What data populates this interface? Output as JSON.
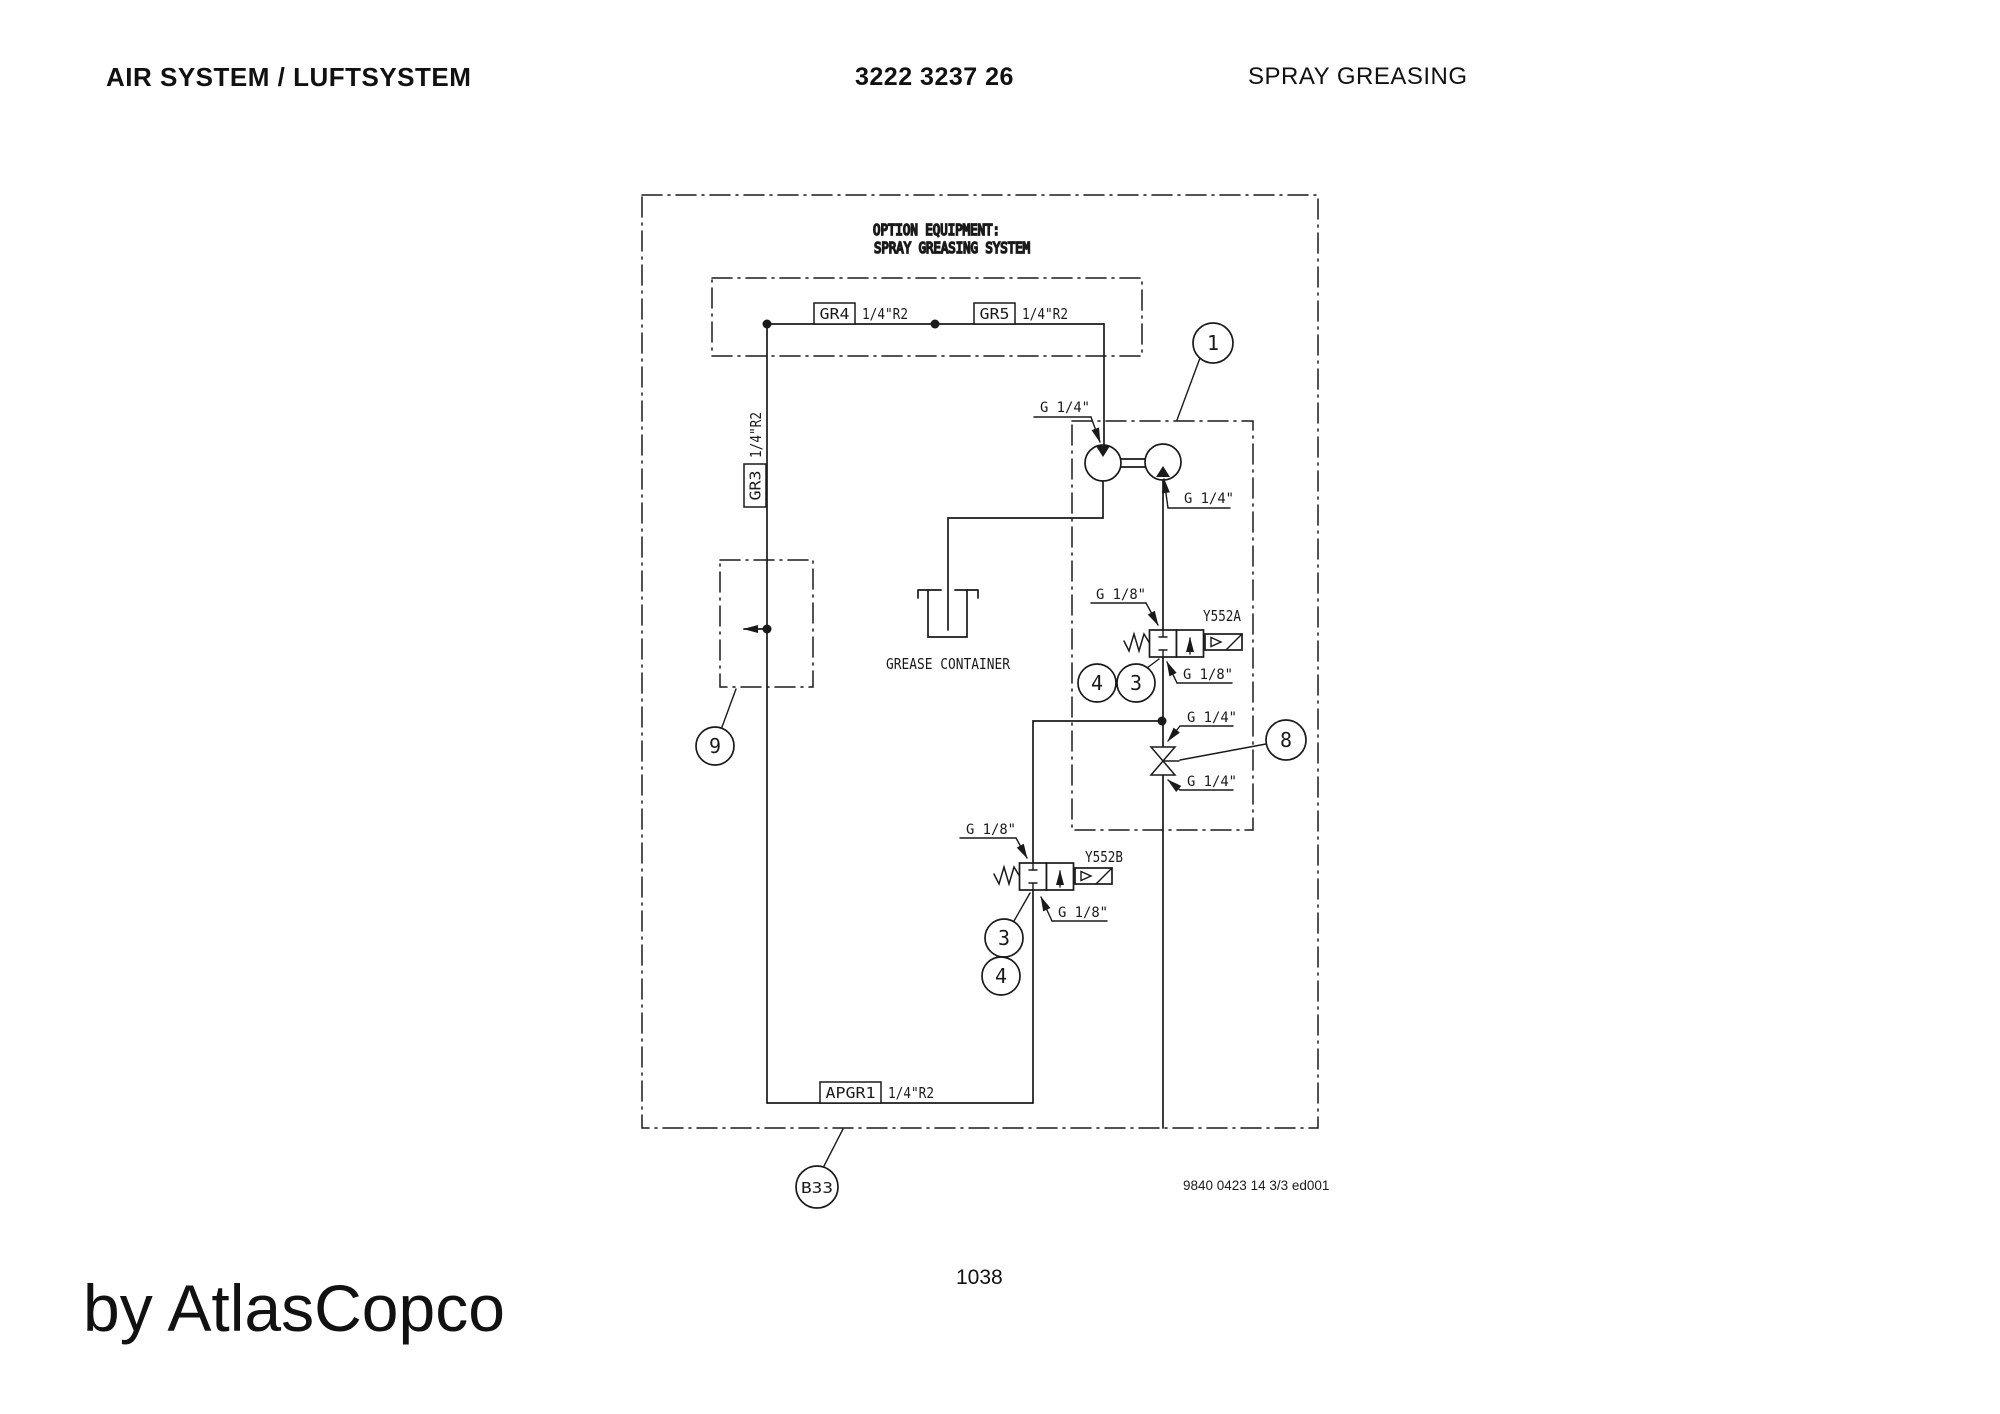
{
  "header": {
    "left_title": "AIR SYSTEM / LUFTSYSTEM",
    "doc_number": "3222 3237 26",
    "right_title": "SPRAY GREASING"
  },
  "diagram": {
    "title_line1": "OPTION EQUIPMENT:",
    "title_line2": "SPRAY GREASING SYSTEM",
    "tags": {
      "gr4": "GR4",
      "gr4_size": "1/4\"R2",
      "gr5": "GR5",
      "gr5_size": "1/4\"R2",
      "gr3": "GR3",
      "gr3_size": "1/4\"R2",
      "apgr1": "APGR1",
      "apgr1_size": "1/4\"R2"
    },
    "ports": {
      "pump_in": "G 1/4\"",
      "pump_out": "G 1/4\"",
      "ya_top": "G 1/8\"",
      "ya_bottom": "G 1/8\"",
      "tee": "G 1/4\"",
      "check_bottom": "G 1/4\"",
      "yb_top": "G 1/8\"",
      "yb_bottom": "G 1/8\""
    },
    "valves": {
      "a": "Y552A",
      "b": "Y552B"
    },
    "grease_container": "GREASE CONTAINER",
    "callouts": {
      "pump": "1",
      "regulator": "9",
      "ya_4": "4",
      "ya_3": "3",
      "check": "8",
      "yb_3": "3",
      "yb_4": "4",
      "b33": "B33"
    },
    "doc_ref": "9840 0423 14 3/3 ed001"
  },
  "footer": {
    "page": "1038",
    "brand": "by AtlasCopco"
  },
  "colors": {
    "ink": "#1a1a1a",
    "paper": "#ffffff"
  }
}
